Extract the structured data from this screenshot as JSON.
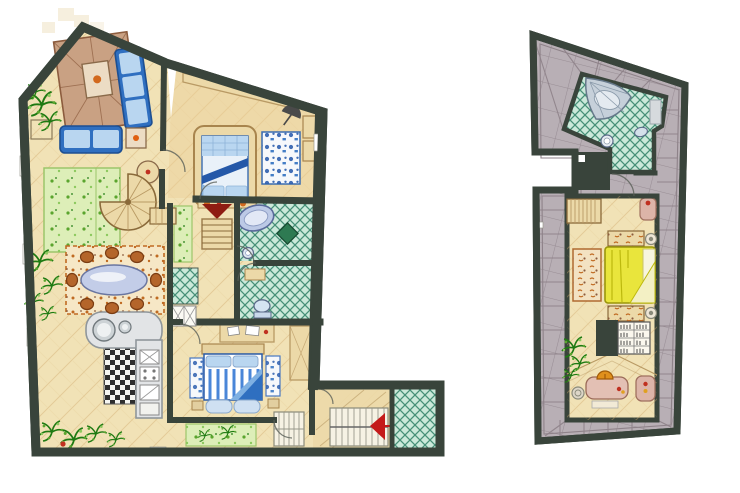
{
  "canvas": {
    "width": 740,
    "height": 493,
    "background": "#ffffff",
    "style": "hand-drawn watercolor floor plan, no text labels"
  },
  "palette": {
    "paper": "#ffffff",
    "wall": "#39443b",
    "floor": "#f1e2b6",
    "floor_warm": "#eccf96",
    "floor_line": "#cfa96a",
    "roof": "#b8afb5",
    "roof_line": "#8e8289",
    "tile_mint": "#cbe9da",
    "tile_line": "#2f8066",
    "tile_mat": "#2e7a52",
    "rug_green": "#ddeeb8",
    "rug_green_line": "#9cc56a",
    "plant": "#5aa52e",
    "plant_light": "#8cc95e",
    "plant_dark": "#1e7a12",
    "sofa_blue": "#2f6fc0",
    "sofa_blue_light": "#b9d6f0",
    "sofa_blue_dark": "#1d4f92",
    "blanket_blue": "#2458a8",
    "bed_linen": "#e9f1f9",
    "rug_white": "#f6f8fb",
    "blotch_blue": "#2e5fae",
    "rug_brown": "#c9a183",
    "rug_brown_line": "#8c5c3e",
    "dining_rug": "#f6e7c6",
    "speck_orange": "#c06a22",
    "chair_brown": "#b4652a",
    "chair_brown_dark": "#7a3c12",
    "glass": "#c3cde8",
    "glass_light": "#eef1f8",
    "counter": "#e2e4e6",
    "counter_line": "#8f969b",
    "checker_dark": "#2e2e2e",
    "checker_light": "#f6f6f2",
    "wood": "#ecd9a8",
    "wood_line": "#b99a64",
    "stair_tread": "#f6f2e4",
    "stair_line": "#98988a",
    "arrow_red": "#c41a1a",
    "wedge_maroon": "#8e1d12",
    "bed_yellow": "#e9e53c",
    "bed_yellow_line": "#bdb90e",
    "pink_furn": "#dcb4a8",
    "pink_furn_line": "#a0705f",
    "lamp_orange": "#e0901c",
    "fixture": "#ccd9e6",
    "fixture_line": "#5a6a88",
    "accent_dot": "#c03020",
    "ghost": "#efe3c4"
  },
  "plans": [
    {
      "id": "ground-floor",
      "position": "left",
      "outline": "irregular pentagon with sloped top-left roof edge and bottom-right entry wing",
      "rooms": [
        {
          "name": "living-room",
          "furniture": [
            "brown-area-rug",
            "coffee-table",
            "blue-sectional-sofa",
            "blue-loveseat",
            "side-table",
            "round-table",
            "corner-plant",
            "wall-bench-outline"
          ]
        },
        {
          "name": "upper-bedroom",
          "furniture": [
            "alcove-double-bed",
            "blue-blotch-rug",
            "wardrobe",
            "ceiling-beam",
            "umbrella",
            "ledge-items"
          ]
        },
        {
          "name": "bathroom",
          "furniture": [
            "oval-bathtub",
            "dark-green-mat",
            "pedestal-sink"
          ]
        },
        {
          "name": "wc",
          "furniture": [
            "toilet",
            "small-shelf"
          ]
        },
        {
          "name": "hallway",
          "furniture": [
            "green-runner-rug",
            "straight-stairs",
            "maroon-direction-wedge",
            "mint-tile-square",
            "white-x-tiles"
          ]
        },
        {
          "name": "stair-core",
          "furniture": [
            "spiral-staircase"
          ]
        },
        {
          "name": "dining-area",
          "furniture": [
            "speckled-rug",
            "oval-glass-table",
            "dining-chairs"
          ],
          "chair_count": 8
        },
        {
          "name": "kitchen",
          "furniture": [
            "l-shaped-counter",
            "double-round-sink",
            "checkered-floor",
            "appliance-squares"
          ]
        },
        {
          "name": "lower-bedroom",
          "furniture": [
            "striped-double-bed",
            "two-blue-blotch-rugs",
            "headboard-desk",
            "wardrobe",
            "foot-stools"
          ]
        },
        {
          "name": "terrace-strip",
          "furniture": [
            "green-speckled-rug",
            "step-grille"
          ]
        },
        {
          "name": "entry-wing",
          "furniture": [
            "wood-floor",
            "staircase",
            "red-direction-arrow",
            "mint-tile-porch",
            "entry-door"
          ]
        }
      ],
      "plants": [
        "top-left-corner",
        "left-edge-middle",
        "bottom-left-corner-with-red-berry"
      ],
      "window_breaks": 6,
      "ghost_sketch_squares": "faded tan squares outside top-left roof slope"
    },
    {
      "id": "attic-floor",
      "position": "right",
      "outline": "tall irregular polygon with left-side notch, ringed by sloped gray roof tiles",
      "rooms": [
        {
          "name": "attic-bathroom",
          "furniture": [
            "corner-shell-tub",
            "round-sink",
            "toilet",
            "wall-shelf"
          ]
        },
        {
          "name": "attic-studio-bedroom",
          "furniture": [
            "straight-stairs",
            "yellow-double-bed",
            "two-scribble-benches",
            "two-round-stools",
            "brown-floral-rug",
            "bookshelf-with-books",
            "chimney-void",
            "pink-cabinet",
            "vanity-desk",
            "orange-dome-lamp",
            "desk-stool",
            "pink-armchair",
            "plant",
            "roof-ridge-lines"
          ]
        }
      ],
      "border": "sloped-roof-tile-band-with-perpendicular-joints"
    }
  ]
}
